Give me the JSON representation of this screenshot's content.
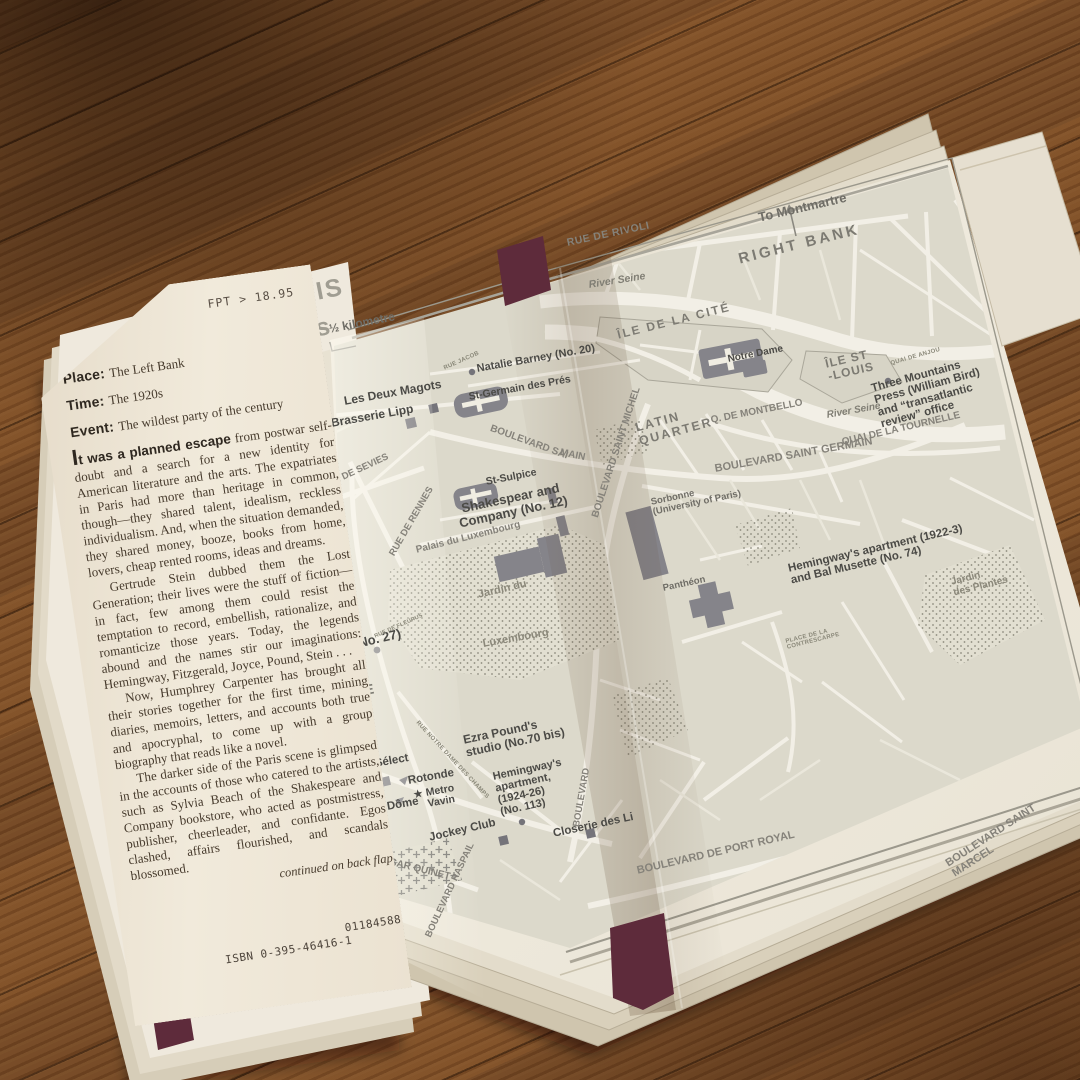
{
  "flap": {
    "price": "FPT > 18.95",
    "fields": [
      {
        "label": "Place:",
        "value": "The Left Bank"
      },
      {
        "label": "Time:",
        "value": "The 1920s"
      },
      {
        "label": "Event:",
        "value": "The wildest party of the century"
      }
    ],
    "lead": "It was a planned escape",
    "lead_rest": " from postwar self-doubt and a search for a new identity for American literature and the arts. The expatriates in Paris had more than heritage in common, though—they shared talent, idealism, reckless individualism. And, when the situation demanded, they shared money, booze, books from home, lovers, cheap rented rooms, ideas and dreams.",
    "paragraphs": [
      "Gertrude Stein dubbed them the Lost Generation; their lives were the stuff of fiction—in fact, few among them could resist the temptation to record, embellish, rationalize, and romanticize those years. Today, the legends abound and the names stir our imaginations: Hemingway, Fitzgerald, Joyce, Pound, Stein . . .",
      "Now, Humphrey Carpenter has brought all their stories together for the first time, mining diaries, memoirs, letters, and accounts both true and apocryphal, to come up with a group biography that reads like a novel.",
      "The darker side of the Paris scene is glimpsed in the accounts of those who catered to the artists, such as Sylvia Beach of the Shakespeare and Company bookstore, who acted as postmistress, publisher, cheerleader, and confidante. Egos clashed, affairs flourished, and scandals blossomed."
    ],
    "continued": "continued on back flap",
    "print_code": "01184588",
    "isbn": "ISBN 0-395-46416-1"
  },
  "map": {
    "labels": [
      {
        "t": "PARIS",
        "x": 258,
        "y": 290,
        "r": -11,
        "fs": 25,
        "cls": "title",
        "ls": 2,
        "n": "map-title"
      },
      {
        "t": "0's",
        "x": 292,
        "y": 320,
        "r": -11,
        "fs": 25,
        "cls": "title",
        "ls": 1,
        "n": "map-title-decade"
      },
      {
        "t": "½ kilometre",
        "x": 328,
        "y": 323,
        "r": -11,
        "fs": 12,
        "cls": "st2",
        "n": "scale-label"
      },
      {
        "t": "To Montmartre",
        "x": 757,
        "y": 211,
        "r": -13,
        "fs": 13,
        "cls": "st2",
        "n": "label-to-montmartre"
      },
      {
        "t": "RUE DE RIVOLI",
        "x": 566,
        "y": 238,
        "r": -12,
        "fs": 10.5,
        "cls": "st",
        "ls": 0.5
      },
      {
        "t": "RIGHT BANK",
        "x": 737,
        "y": 252,
        "r": -14,
        "fs": 15,
        "cls": "area",
        "ls": 3
      },
      {
        "t": "River Seine",
        "x": 588,
        "y": 280,
        "r": -9,
        "fs": 10.5,
        "cls": "riv"
      },
      {
        "t": "ÎLE DE LA CITÉ",
        "x": 616,
        "y": 329,
        "r": -14,
        "fs": 12,
        "cls": "area",
        "ls": 2
      },
      {
        "t": "Notre Dame",
        "x": 727,
        "y": 355,
        "r": -11,
        "fs": 10,
        "cls": "bold"
      },
      {
        "t": "ÎLE ST\n-LOUIS",
        "x": 824,
        "y": 358,
        "r": -13,
        "fs": 12,
        "cls": "area",
        "ls": 1
      },
      {
        "t": "QUAI DE ANJOU",
        "x": 890,
        "y": 361,
        "r": -16,
        "fs": 6,
        "cls": "tiny"
      },
      {
        "t": "Three Mountains\nPress (William Bird)\nand “transatlantic\nreview” office",
        "x": 870,
        "y": 383,
        "r": -15,
        "fs": 11.5,
        "cls": "bold"
      },
      {
        "t": "Q. DE MONTBELLO",
        "x": 710,
        "y": 416,
        "r": -11,
        "fs": 10,
        "cls": "st"
      },
      {
        "t": "River Seine",
        "x": 826,
        "y": 411,
        "r": -10,
        "fs": 10,
        "cls": "riv"
      },
      {
        "t": "QUAI DE LA TOURNELLE",
        "x": 841,
        "y": 438,
        "r": -13,
        "fs": 10,
        "cls": "st"
      },
      {
        "t": "RUE JACOB",
        "x": 443,
        "y": 366,
        "r": -24,
        "fs": 6,
        "cls": "tiny"
      },
      {
        "t": "Natalie Barney (No. 20)",
        "x": 476,
        "y": 364,
        "r": -10,
        "fs": 11,
        "cls": "bold"
      },
      {
        "t": "Les Deux Magots",
        "x": 343,
        "y": 395,
        "r": -10,
        "fs": 12,
        "cls": "bold"
      },
      {
        "t": "St-Germain des Prés",
        "x": 468,
        "y": 392,
        "r": -10,
        "fs": 10.5,
        "cls": "bold"
      },
      {
        "t": "Brasserie Lipp",
        "x": 330,
        "y": 417,
        "r": -10,
        "fs": 12,
        "cls": "bold"
      },
      {
        "t": "BOULEVARD SAI",
        "x": 492,
        "y": 424,
        "r": 20,
        "fs": 10,
        "cls": "st"
      },
      {
        "t": "MAIN",
        "x": 561,
        "y": 448,
        "r": 12,
        "fs": 10,
        "cls": "st"
      },
      {
        "t": "RUE DE SEVIES",
        "x": 320,
        "y": 483,
        "r": -25,
        "fs": 9.5,
        "cls": "st"
      },
      {
        "t": "RUE DE RENNES",
        "x": 388,
        "y": 553,
        "r": -60,
        "fs": 9.5,
        "cls": "st"
      },
      {
        "t": "BOULEVARD RA",
        "x": 308,
        "y": 585,
        "r": -72,
        "fs": 9.5,
        "cls": "st"
      },
      {
        "t": "St-Sulpice",
        "x": 485,
        "y": 477,
        "r": -11,
        "fs": 10.5,
        "cls": "bold"
      },
      {
        "t": "Shakespear and\nCompany (No. 12)",
        "x": 455,
        "y": 503,
        "r": -12,
        "fs": 13,
        "cls": "bold",
        "ctr": 1
      },
      {
        "t": "Palais du Luxembourg",
        "x": 415,
        "y": 546,
        "r": -14,
        "fs": 10,
        "cls": "st"
      },
      {
        "t": "BOULEVARD SAINT MICHEL",
        "x": 591,
        "y": 516,
        "r": -72,
        "fs": 10,
        "cls": "st"
      },
      {
        "t": "LATIN\nQUARTER",
        "x": 634,
        "y": 422,
        "r": -15,
        "fs": 12.5,
        "cls": "area",
        "ls": 2
      },
      {
        "t": "BOULEVARD SAINT GERMAIN",
        "x": 714,
        "y": 464,
        "r": -10,
        "fs": 11,
        "cls": "st"
      },
      {
        "t": "Sorbonne\n(University of Paris)",
        "x": 650,
        "y": 498,
        "r": -12,
        "fs": 9.5,
        "cls": "st2"
      },
      {
        "t": "Panthéon",
        "x": 662,
        "y": 584,
        "r": -12,
        "fs": 9.5,
        "cls": "st2"
      },
      {
        "t": "Hemingway's apartment (1922-3)\nand Bal Musette (No. 74)",
        "x": 787,
        "y": 563,
        "r": -13,
        "fs": 11.5,
        "cls": "bold"
      },
      {
        "t": "PLACE DE LA\nCONTRESCARPE",
        "x": 785,
        "y": 639,
        "r": -14,
        "fs": 6,
        "cls": "tiny"
      },
      {
        "t": "Jardin du",
        "x": 477,
        "y": 590,
        "r": -13,
        "fs": 11,
        "cls": "park"
      },
      {
        "t": "Luxembourg",
        "x": 482,
        "y": 639,
        "r": -10,
        "fs": 11,
        "cls": "park"
      },
      {
        "t": "in (No. 27)",
        "x": 338,
        "y": 641,
        "r": -13,
        "fs": 13,
        "cls": "bold"
      },
      {
        "t": "RUE DE FLEURUS",
        "x": 374,
        "y": 635,
        "r": -24,
        "fs": 5.5,
        "cls": "tiny"
      },
      {
        "t": "SSE",
        "x": 341,
        "y": 687,
        "r": -10,
        "fs": 14,
        "cls": "area",
        "ls": 2
      },
      {
        "t": "ER'')",
        "x": 335,
        "y": 710,
        "r": -10,
        "fs": 12,
        "cls": "bold"
      },
      {
        "t": "Ezra Pound's\nstudio (No.70 bis)",
        "x": 462,
        "y": 734,
        "r": -12,
        "fs": 12,
        "cls": "bold"
      },
      {
        "t": "RUE NOTRE DAME DES CHAMPS",
        "x": 419,
        "y": 720,
        "r": 47,
        "fs": 6,
        "cls": "tiny"
      },
      {
        "t": "Sélect",
        "x": 374,
        "y": 758,
        "r": -10,
        "fs": 11.5,
        "cls": "bold"
      },
      {
        "t": "Rotonde",
        "x": 407,
        "y": 775,
        "r": -10,
        "fs": 11.5,
        "cls": "bold"
      },
      {
        "t": "★",
        "x": 413,
        "y": 791,
        "r": -10,
        "fs": 10,
        "cls": "bold",
        "n": "metro-star-icon"
      },
      {
        "t": "Metro\nVavin",
        "x": 425,
        "y": 788,
        "r": -10,
        "fs": 10.5,
        "cls": "bold"
      },
      {
        "t": "Dôme",
        "x": 386,
        "y": 801,
        "r": -10,
        "fs": 11.5,
        "cls": "bold"
      },
      {
        "t": "go",
        "x": 359,
        "y": 804,
        "r": -10,
        "fs": 11.5,
        "cls": "bold"
      },
      {
        "t": "Hemingway's\napartment,\n(1924-26)\n(No. 113)",
        "x": 492,
        "y": 772,
        "r": -12,
        "fs": 11,
        "cls": "bold"
      },
      {
        "t": "Jockey Club",
        "x": 428,
        "y": 832,
        "r": -13,
        "fs": 11.5,
        "cls": "bold"
      },
      {
        "t": "Closerie des Li",
        "x": 552,
        "y": 828,
        "r": -12,
        "fs": 11.5,
        "cls": "bold"
      },
      {
        "t": "BOULEVARD",
        "x": 572,
        "y": 826,
        "r": -80,
        "fs": 9.5,
        "cls": "st"
      },
      {
        "t": "RD EDGAR QUINET",
        "x": 360,
        "y": 850,
        "r": 14,
        "fs": 10,
        "cls": "st"
      },
      {
        "t": "BOULEVARD RASPAIL",
        "x": 424,
        "y": 935,
        "r": -65,
        "fs": 9.5,
        "cls": "st"
      },
      {
        "t": "BOULEVARD DE PORT ROYAL",
        "x": 636,
        "y": 866,
        "r": -13,
        "fs": 11,
        "cls": "st"
      },
      {
        "t": "BOULEVARD SAINT MARCEL",
        "x": 944,
        "y": 860,
        "r": -33,
        "fs": 11,
        "cls": "st"
      },
      {
        "t": "Jardin\ndes Plantes",
        "x": 950,
        "y": 578,
        "r": -14,
        "fs": 10,
        "cls": "park"
      }
    ]
  },
  "colors": {
    "wood": "#7d4f28",
    "page": "#ece7db",
    "map_blocks": "#dcd9cb",
    "street": "#f2efe6",
    "building": "#85848a",
    "cover_maroon": "#5e2b3b",
    "label_dark": "#4b4a46",
    "label_gray": "#85827a"
  }
}
